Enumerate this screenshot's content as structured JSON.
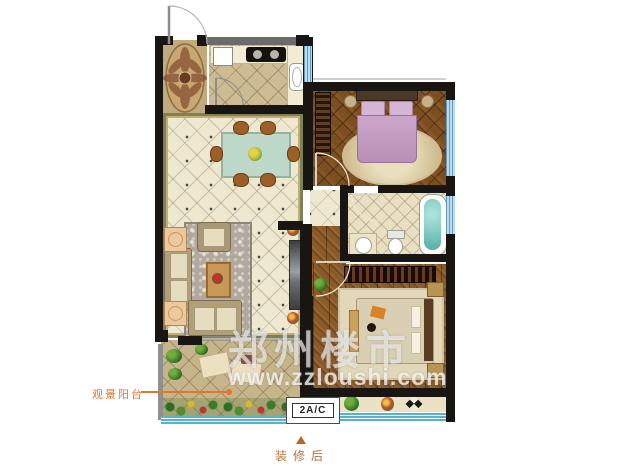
{
  "labels": {
    "balcony": "观景阳台",
    "unit": "2A/C",
    "caption": "装修后"
  },
  "watermark": {
    "title": "郑州楼市",
    "url": "www.zzloushi.com"
  },
  "colors": {
    "accent_orange": "#e0762f",
    "caption_brown": "#b8703a",
    "wall_black": "#181512",
    "tile_cream": "#efe8d1",
    "tile_tan": "#cdbb93",
    "wood_brown": "#8a5a28",
    "window_blue": "#bcdcee",
    "bathtub_teal": "#7cc8c0",
    "bed_pink": "#c7a3c6",
    "watermark_white": "rgba(255,255,255,0.65)"
  }
}
